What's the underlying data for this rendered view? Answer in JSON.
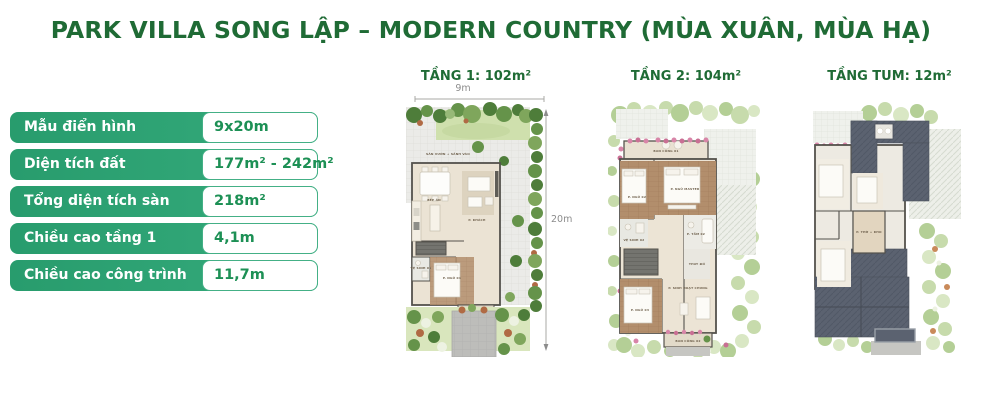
{
  "title": "PARK VILLA SONG LẬP – MODERN COUNTRY (MÙA XUÂN, MÙA HẠ)",
  "colors": {
    "title_green": "#1f6b35",
    "table_label_green": "#2ca578",
    "table_value_green": "#1d9055",
    "table_border_green": "#44b086",
    "dim_gray": "#8c8c8c"
  },
  "spec_table": {
    "rows": [
      {
        "label": "Mẫu điển hình",
        "value": "9x20m"
      },
      {
        "label": "Diện tích đất",
        "value": "177m² - 242m²"
      },
      {
        "label": "Tổng diện tích sàn",
        "value": "218m²"
      },
      {
        "label": "Chiều cao tầng 1",
        "value": "4,1m"
      },
      {
        "label": "Chiều cao công trình",
        "value": "11,7m"
      }
    ]
  },
  "plans": [
    {
      "title": "TẦNG 1: 102m²"
    },
    {
      "title": "TẦNG 2: 104m²"
    },
    {
      "title": "TẦNG TUM: 12m²"
    }
  ],
  "dimensions": {
    "width_label": "9m",
    "depth_label": "20m"
  },
  "rooms": {
    "plan1": [
      "SÂN VƯỜN + SẢNH VÀO",
      "BẾP ĂN",
      "P. KHÁCH",
      "VỆ SINH 01",
      "P. NGỦ 01"
    ],
    "plan2": [
      "BAN CÔNG 01",
      "P. NGỦ MASTER",
      "P. NGỦ 02",
      "VỆ SINH 02",
      "P. TẮM 02",
      "THAY ĐỒ",
      "P. NGỦ 03",
      "P. SINH HOẠT CHUNG",
      "BAN CÔNG 02"
    ],
    "plan3": [
      "P. THỜ + KHO"
    ]
  }
}
